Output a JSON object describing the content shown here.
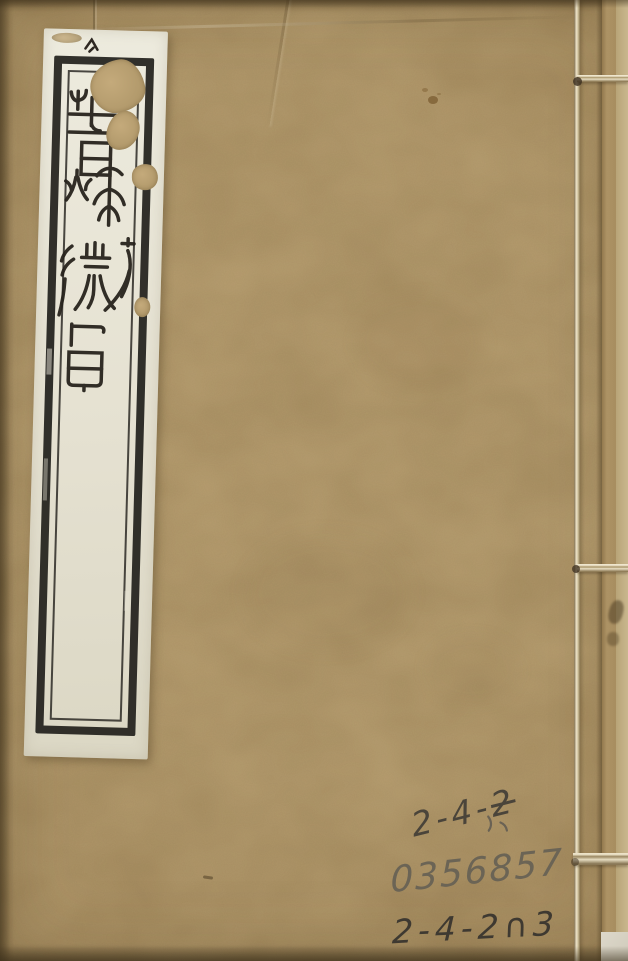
{
  "cover": {
    "background_color": "#b29a6c",
    "title_label": {
      "text": "春秋微旨",
      "characters": [
        "春",
        "秋",
        "微",
        "旨"
      ],
      "script_style": "seal script, vertical, black ink on white paper slip",
      "paper_color": "#e8e4d6",
      "frame_color": "#211f1b"
    },
    "handwriting": {
      "pencil_color": "#4a443a",
      "line1": {
        "prefix": "2-4-",
        "struck": "2"
      },
      "line2": "0356857",
      "line3": "2-4-2∩3"
    },
    "binding": {
      "thread_color": "#ddd2b6",
      "stitches_y": [
        80,
        568,
        860
      ]
    }
  }
}
